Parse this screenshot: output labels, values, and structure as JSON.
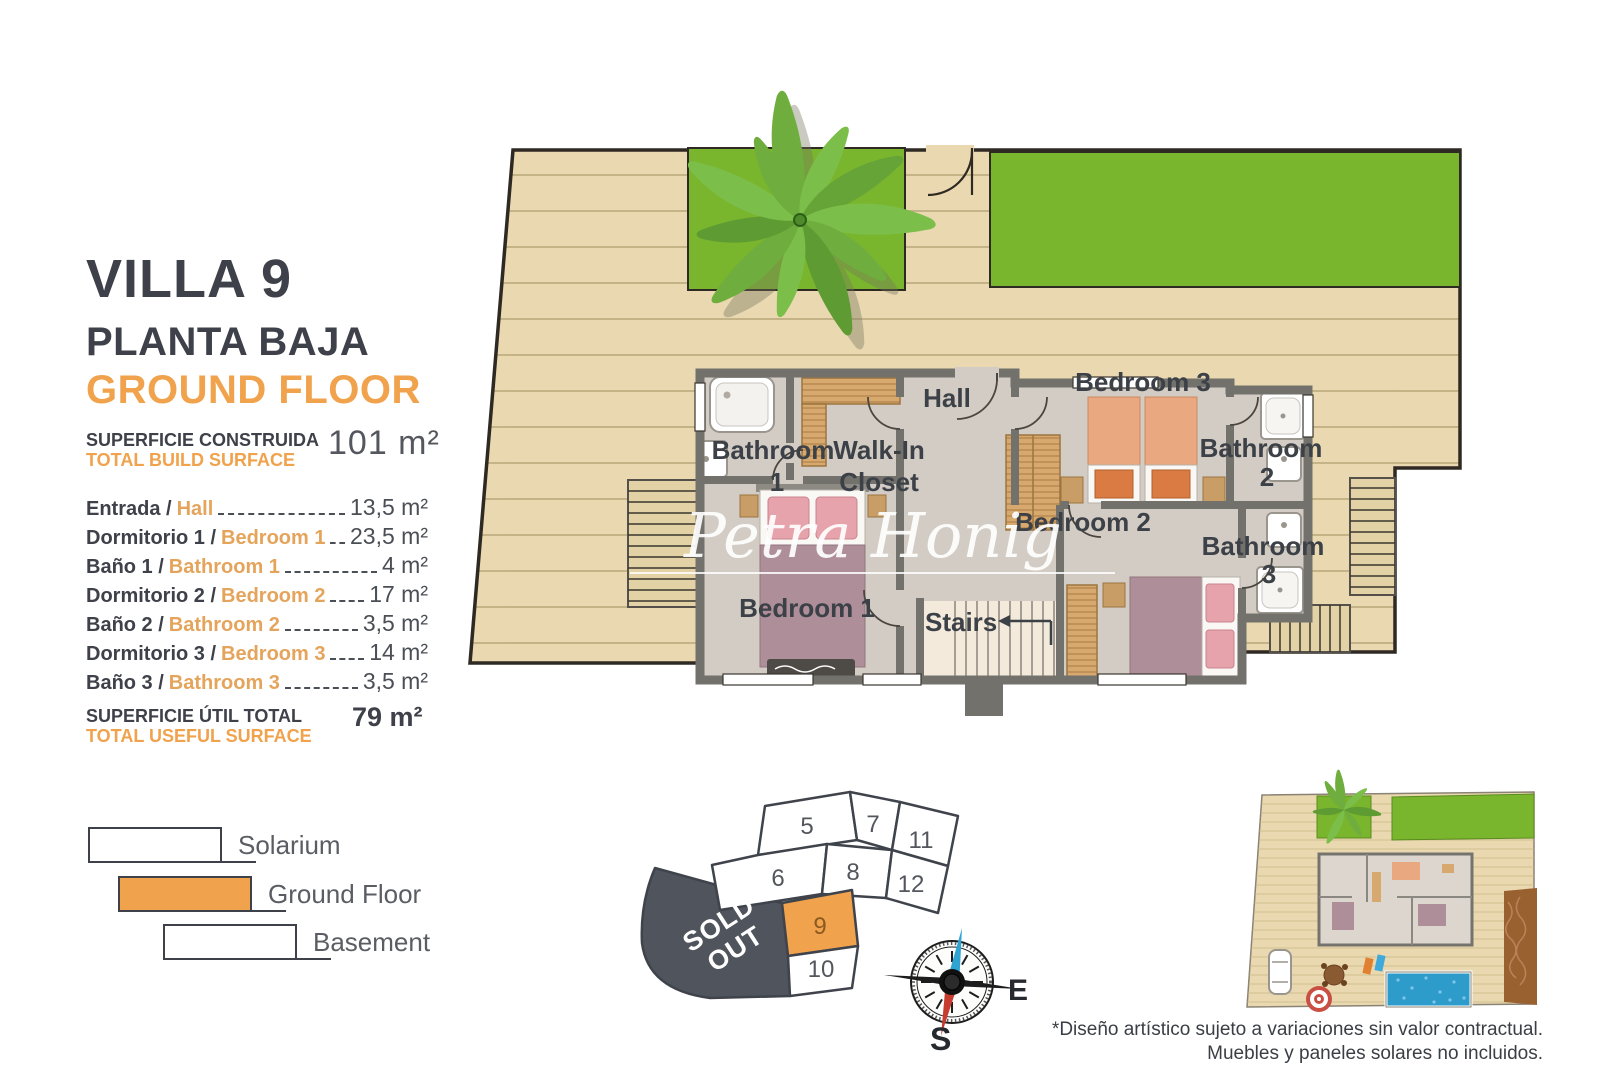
{
  "left_panel": {
    "villa_title": "VILLA 9",
    "floor_title_es": "PLANTA BAJA",
    "floor_title_en": "GROUND FLOOR",
    "build_surface_label_es": "SUPERFICIE CONSTRUIDA",
    "build_surface_label_en": "TOTAL BUILD SURFACE",
    "build_surface_value": "101 m²",
    "rooms": [
      {
        "name_es": "Entrada /",
        "name_en": "Hall",
        "area": "13,5 m²"
      },
      {
        "name_es": "Dormitorio 1 /",
        "name_en": "Bedroom 1",
        "area": "23,5 m²"
      },
      {
        "name_es": "Baño 1 /",
        "name_en": "Bathroom 1",
        "area": "4 m²"
      },
      {
        "name_es": "Dormitorio 2 /",
        "name_en": "Bedroom 2",
        "area": "17 m²"
      },
      {
        "name_es": "Baño 2 /",
        "name_en": "Bathroom 2",
        "area": "3,5 m²"
      },
      {
        "name_es": "Dormitorio 3 /",
        "name_en": "Bedroom 3",
        "area": "14 m²"
      },
      {
        "name_es": "Baño 3 /",
        "name_en": "Bathroom 3",
        "area": "3,5 m²"
      }
    ],
    "useful_surface_label_es": "SUPERFICIE ÚTIL TOTAL",
    "useful_surface_label_en": "TOTAL USEFUL SURFACE",
    "useful_surface_value": "79 m²",
    "legend": [
      {
        "label": "Solarium",
        "highlighted": false
      },
      {
        "label": "Ground Floor",
        "highlighted": true
      },
      {
        "label": "Basement",
        "highlighted": false
      }
    ]
  },
  "floor_plan": {
    "watermark": "Petra Honig",
    "labels": {
      "hall": "Hall",
      "walk_in_line1": "Walk-In",
      "walk_in_line2": "Closet",
      "bathroom_word": "Bathroom",
      "bathroom1_num": "1",
      "bathroom2_num": "2",
      "bathroom3_num": "3",
      "bedroom1": "Bedroom 1",
      "bedroom2": "Bedroom 2",
      "bedroom3": "Bedroom 3",
      "stairs": "Stairs"
    }
  },
  "plot_map": {
    "sold_out_line1": "SOLD",
    "sold_out_line2": "OUT",
    "highlighted_plot": "9",
    "plots": {
      "p5": "5",
      "p6": "6",
      "p7": "7",
      "p8": "8",
      "p9": "9",
      "p10": "10",
      "p11": "11",
      "p12": "12"
    }
  },
  "compass": {
    "east_label": "E",
    "south_label": "S"
  },
  "disclaimer": {
    "line1": "*Diseño artístico sujeto a variaciones sin valor contractual.",
    "line2": "Muebles y paneles solares no incluidos."
  },
  "colors": {
    "accent_orange": "#F0A24C",
    "dark_text": "#3E4149",
    "deck_tan": "#EAD9B0",
    "lawn_green": "#79B52D",
    "wall_gray": "#73716C",
    "floor_gray": "#D3CCC5",
    "sold_out_gray": "#50545C",
    "pool_blue": "#2E9CCB"
  }
}
